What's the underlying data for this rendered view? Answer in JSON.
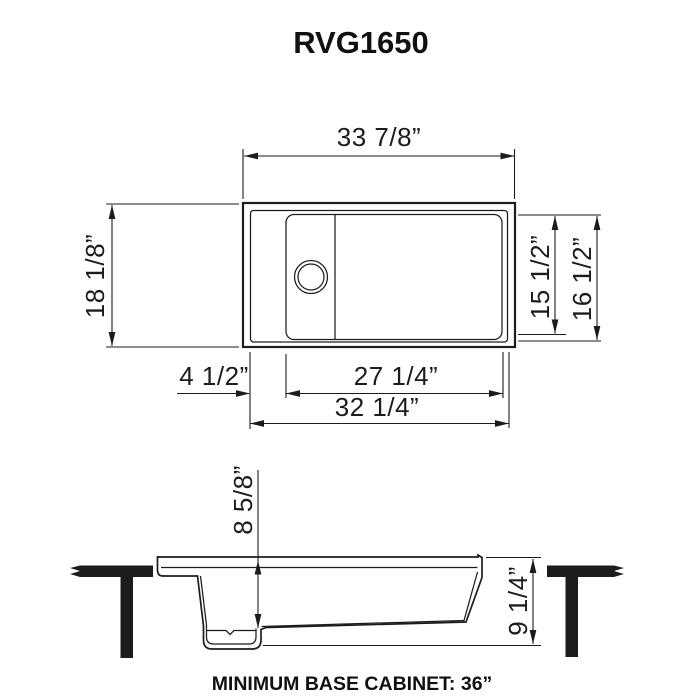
{
  "title": "RVG1650",
  "line_color": "#1c1c1c",
  "top_view": {
    "overall_width": "33 7/8”",
    "overall_depth": "18 1/8”",
    "bowl_inner_depth": "15 1/2”",
    "bowl_outer_depth": "16 1/2”",
    "drainboard_ledge_width": "4 1/2”",
    "bowl_width": "27 1/4”",
    "inner_rim_width": "32 1/4”"
  },
  "section_view": {
    "bowl_depth": "8 5/8”",
    "overall_height": "9 1/4”"
  },
  "footer": {
    "note": "MINIMUM BASE CABINET: 36”"
  }
}
